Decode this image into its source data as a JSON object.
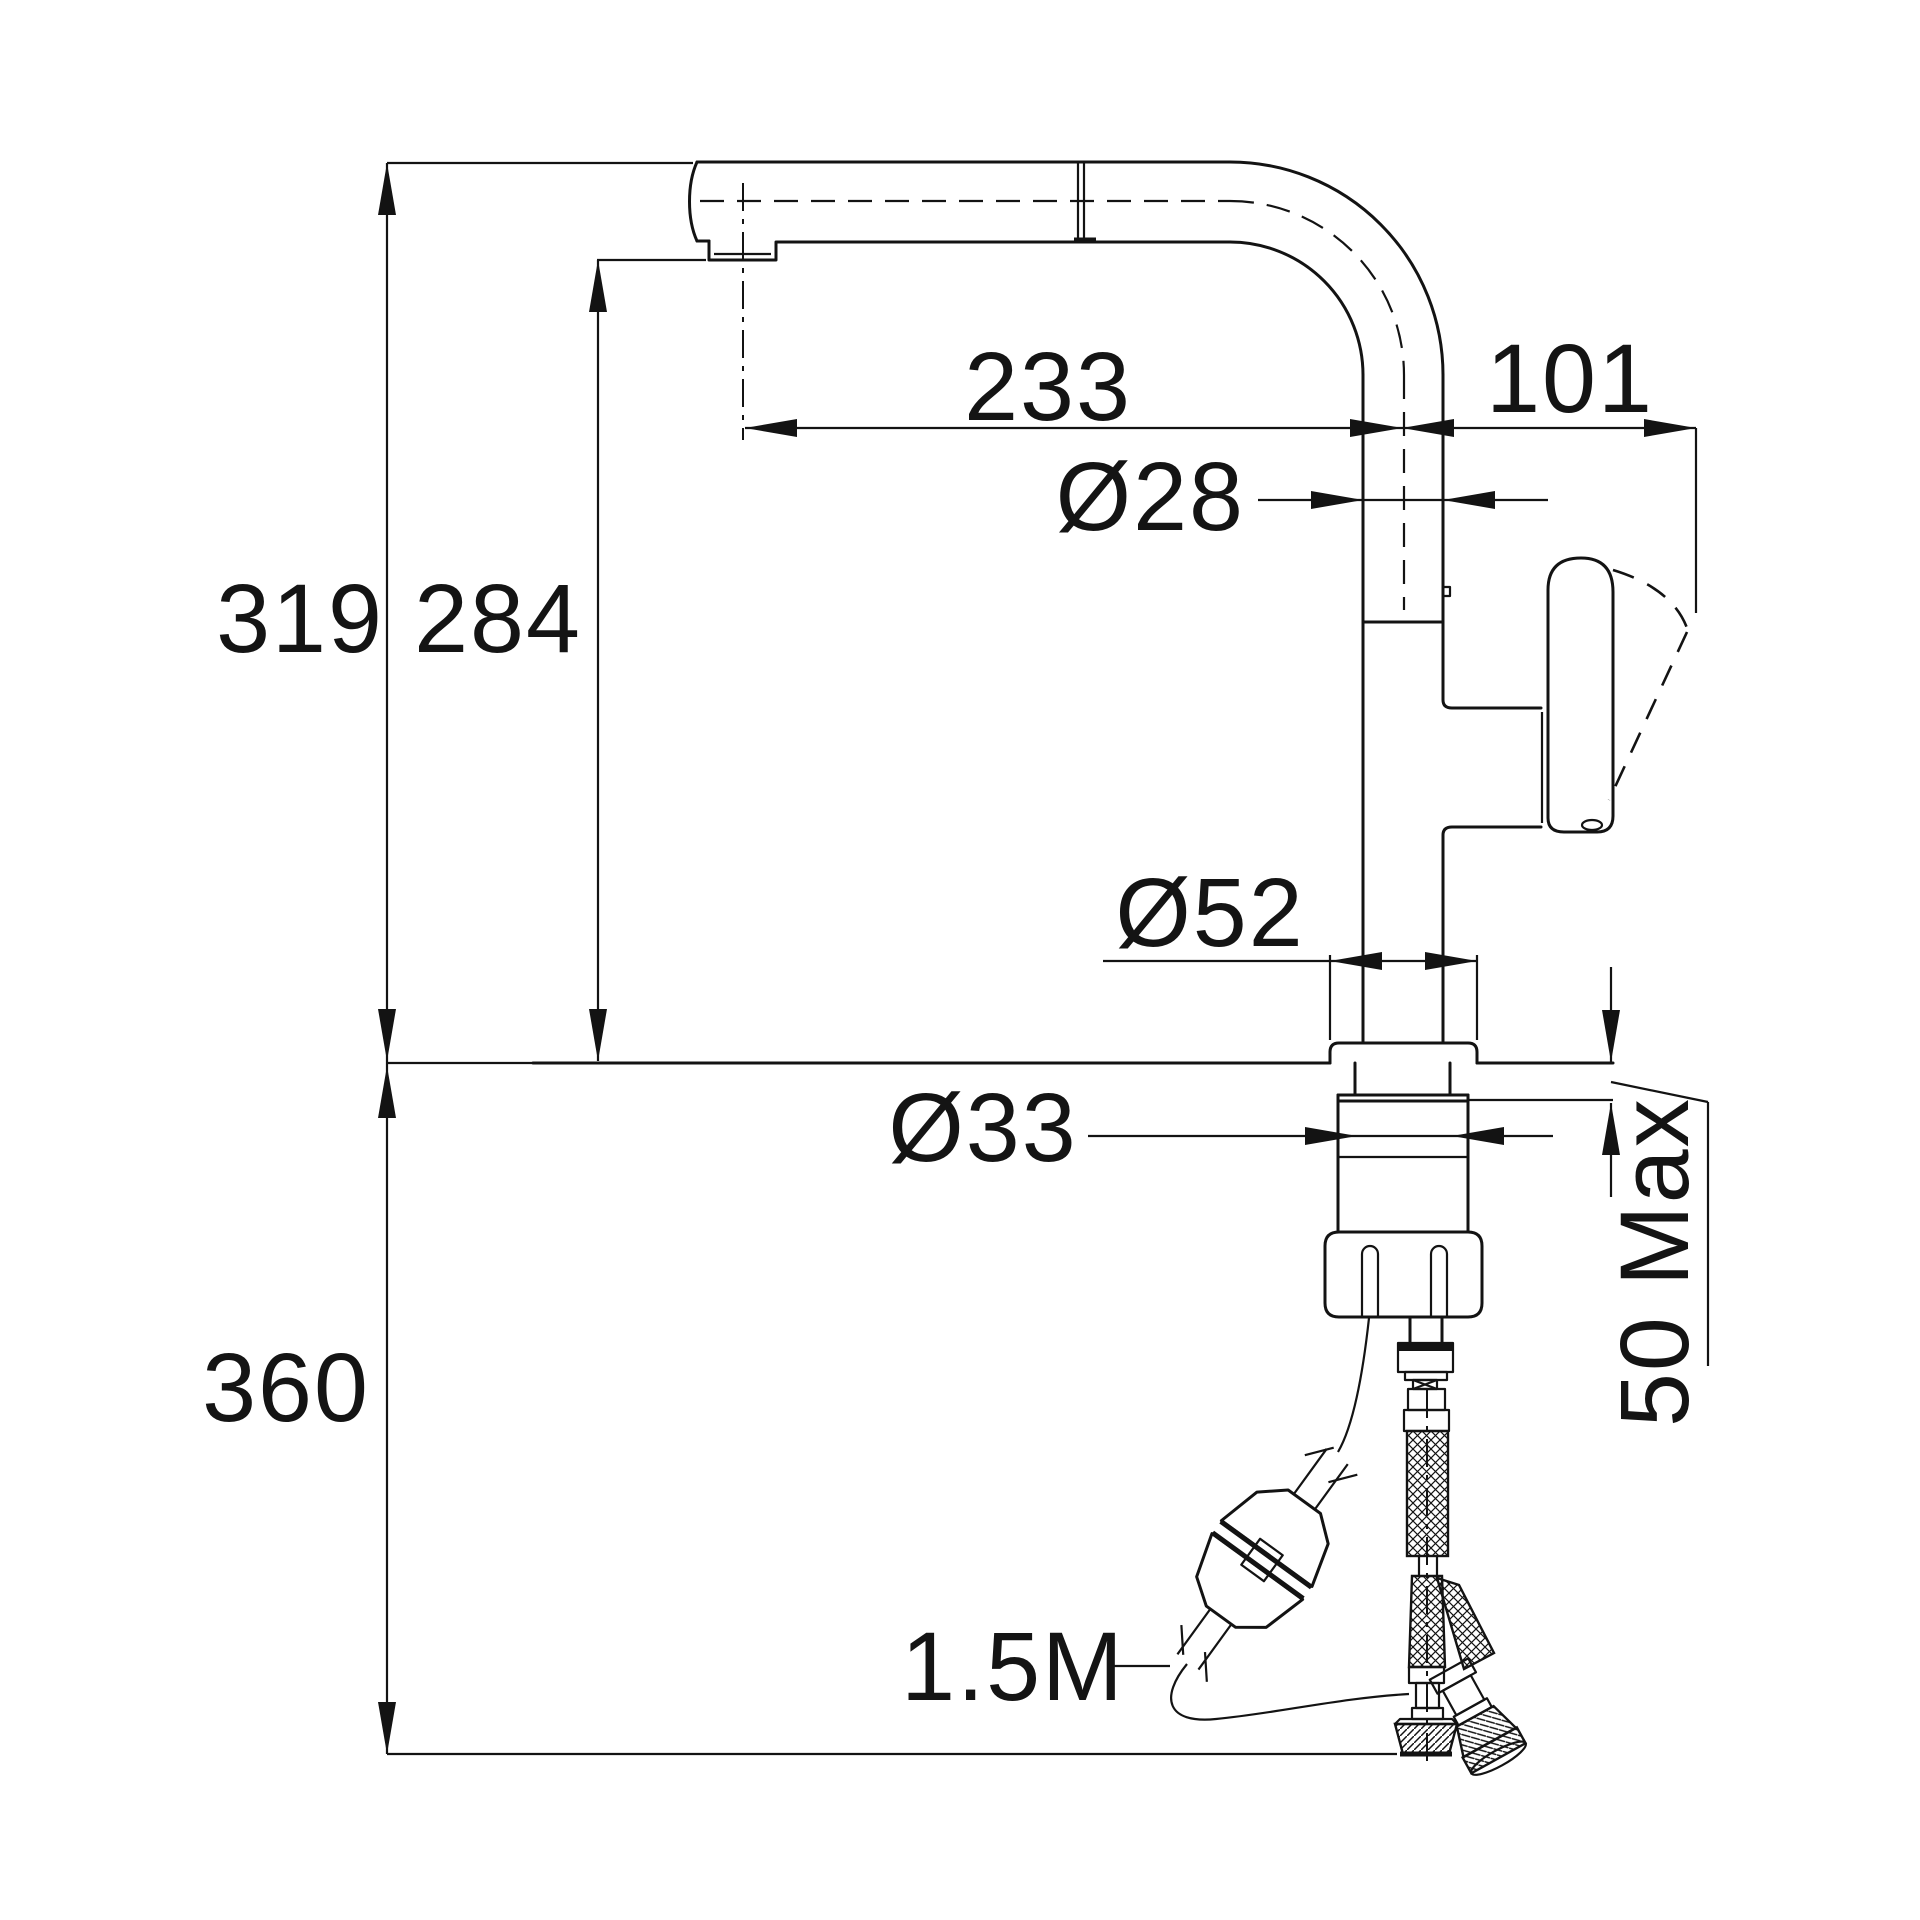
{
  "drawing": {
    "type": "faucet-technical-drawing",
    "line_color": "#131313",
    "background_color": "#ffffff"
  },
  "labels": {
    "spout_reach": "233",
    "spout_to_handle_offset": "101",
    "spout_tube_diameter": "Ø28",
    "overall_height": "319",
    "spout_clearance_height": "284",
    "base_diameter": "Ø52",
    "mounting_shank_diameter": "Ø33",
    "max_counter_thickness": "50 Max",
    "under_counter_depth": "360",
    "hose_length": "1.5M"
  }
}
